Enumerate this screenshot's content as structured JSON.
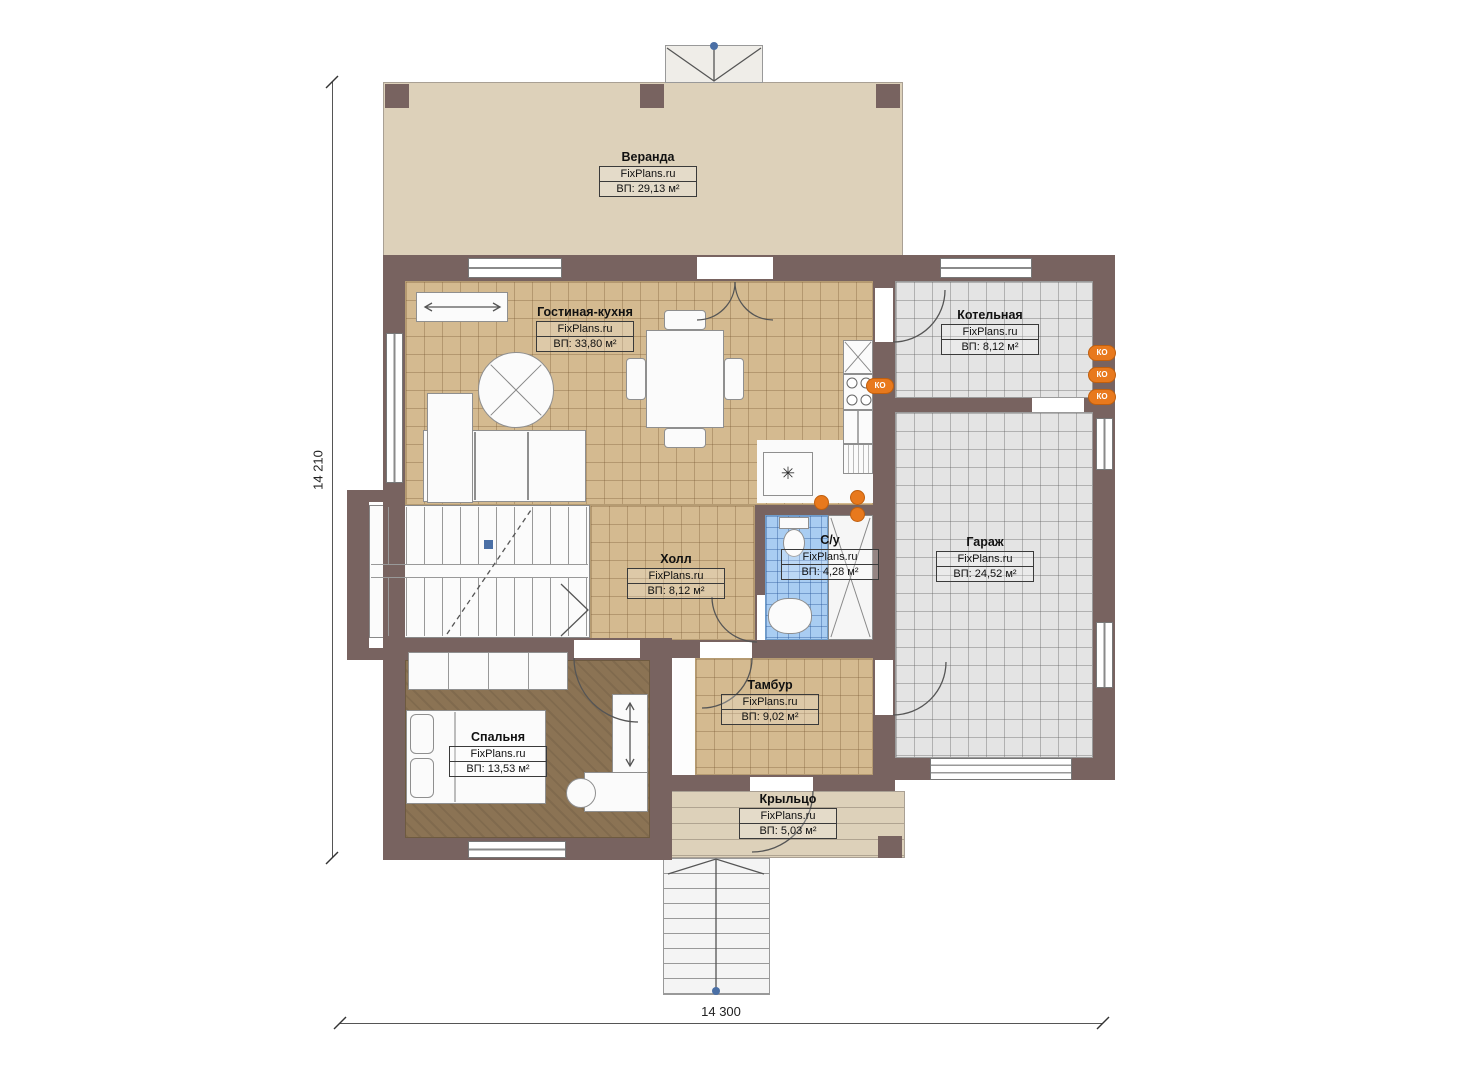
{
  "brand": "FixPlans.ru",
  "dimensions": {
    "left": "14 210",
    "bottom": "14 300"
  },
  "rooms": [
    {
      "name": "Веранда",
      "area": "ВП: 29,13 м²"
    },
    {
      "name": "Гостиная-кухня",
      "area": "ВП: 33,80 м²"
    },
    {
      "name": "Котельная",
      "area": "ВП: 8,12 м²"
    },
    {
      "name": "Холл",
      "area": "ВП: 8,12 м²"
    },
    {
      "name": "С/у",
      "area": "ВП: 4,28 м²"
    },
    {
      "name": "Гараж",
      "area": "ВП: 24,52 м²"
    },
    {
      "name": "Тамбур",
      "area": "ВП: 9,02 м²"
    },
    {
      "name": "Спальня",
      "area": "ВП: 13,53 м²"
    },
    {
      "name": "Крыльцо",
      "area": "ВП: 5,03 м²"
    }
  ],
  "badges": {
    "heating_label": "КО"
  },
  "symbols": {
    "vent": "✳"
  },
  "colors": {
    "wall": "#786360",
    "tile_tan": "#d4ba90",
    "tile_gray": "#e4e4e4",
    "tile_blue": "#a9cdf2",
    "wood": "#8b7354",
    "veranda": "#ddd1ba",
    "accent_orange": "#e8791d",
    "marker_blue": "#4a6fa5"
  }
}
